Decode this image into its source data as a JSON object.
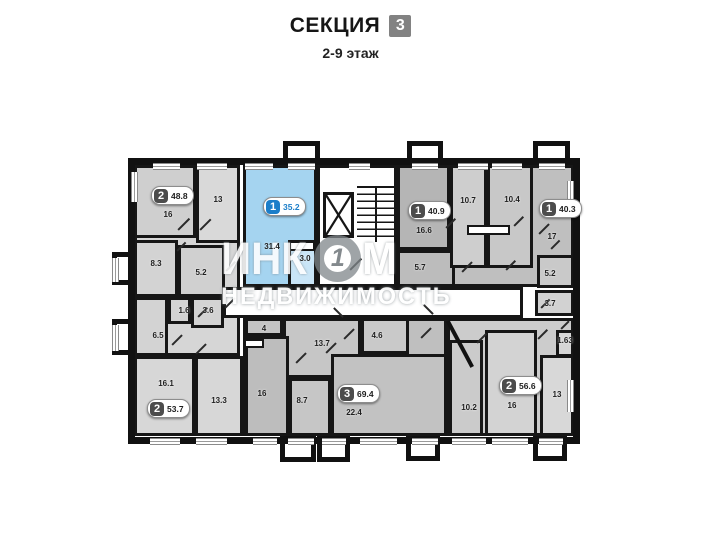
{
  "header": {
    "title": "СЕКЦИЯ",
    "section_number": "3",
    "subtitle": "2-9 этаж"
  },
  "watermark": {
    "part1": "ИНК",
    "logo_glyph": "1",
    "part2": "М",
    "line2": "НЕДВИЖИМОСТЬ"
  },
  "colors": {
    "highlight_apartment": "#a5d4f0",
    "highlight_badge": "#1b7ec9",
    "badge_square": "#4c4c4c",
    "section_badge": "#828282",
    "wall": "#111111"
  },
  "plan": {
    "rooms": [
      {
        "n": "hall-left",
        "x": 134,
        "y": 235,
        "w": 106,
        "h": 121,
        "bg": "#d6d6d6"
      },
      {
        "n": "room-16-top",
        "x": 134,
        "y": 165,
        "w": 62,
        "h": 73,
        "bg": "#cfcfcf"
      },
      {
        "n": "room-13-top",
        "x": 196,
        "y": 165,
        "w": 44,
        "h": 78,
        "bg": "#d9d9d9"
      },
      {
        "n": "room-8-3",
        "x": 134,
        "y": 240,
        "w": 44,
        "h": 57,
        "bg": "#d3d3d3"
      },
      {
        "n": "room-5-2-left",
        "x": 178,
        "y": 245,
        "w": 47,
        "h": 52,
        "bg": "#d0d0d0"
      },
      {
        "n": "room-1-6",
        "x": 168,
        "y": 297,
        "w": 23,
        "h": 27,
        "bg": "#d3d3d3"
      },
      {
        "n": "room-3-6",
        "x": 191,
        "y": 297,
        "w": 33,
        "h": 31,
        "bg": "#d3d3d3"
      },
      {
        "n": "room-6-5",
        "x": 134,
        "y": 297,
        "w": 34,
        "h": 59,
        "bg": "#d3d3d3"
      },
      {
        "n": "room-16-1",
        "x": 134,
        "y": 356,
        "w": 61,
        "h": 80,
        "bg": "#d7d7d7"
      },
      {
        "n": "room-13-3",
        "x": 195,
        "y": 356,
        "w": 48,
        "h": 80,
        "bg": "#d7d7d7"
      },
      {
        "n": "apt-highlight-35-2",
        "x": 243,
        "y": 165,
        "w": 74,
        "h": 122,
        "bg": "#a5d4f0"
      },
      {
        "n": "room-3-0",
        "x": 288,
        "y": 240,
        "w": 29,
        "h": 47,
        "bg": "#c9e5f7"
      },
      {
        "n": "stair-core",
        "x": 317,
        "y": 165,
        "w": 80,
        "h": 122,
        "bg": "#ffffff"
      },
      {
        "n": "apt-topright-base",
        "x": 397,
        "y": 165,
        "w": 177,
        "h": 122,
        "bg": "#bfbfbf"
      },
      {
        "n": "room-16-6",
        "x": 397,
        "y": 165,
        "w": 53,
        "h": 85,
        "bg": "#b5b5b5"
      },
      {
        "n": "room-5-7",
        "x": 397,
        "y": 250,
        "w": 58,
        "h": 37,
        "bg": "#bcbcbc"
      },
      {
        "n": "room-10-7",
        "x": 450,
        "y": 165,
        "w": 37,
        "h": 103,
        "bg": "#cecece"
      },
      {
        "n": "room-10-4",
        "x": 487,
        "y": 165,
        "w": 46,
        "h": 103,
        "bg": "#c8c8c8"
      },
      {
        "n": "room-5-2-right",
        "x": 537,
        "y": 255,
        "w": 37,
        "h": 33,
        "bg": "#c9c9c9"
      },
      {
        "n": "room-3-7",
        "x": 535,
        "y": 290,
        "w": 39,
        "h": 26,
        "bg": "#d2d2d2"
      },
      {
        "n": "apt-botmid-base",
        "x": 243,
        "y": 318,
        "w": 204,
        "h": 118,
        "bg": "#bfbfbf"
      },
      {
        "n": "room-4",
        "x": 245,
        "y": 318,
        "w": 38,
        "h": 18,
        "bg": "#c4c4c4"
      },
      {
        "n": "room-13-7",
        "x": 283,
        "y": 318,
        "w": 78,
        "h": 60,
        "bg": "#c6c6c6"
      },
      {
        "n": "room-4-6",
        "x": 361,
        "y": 318,
        "w": 48,
        "h": 36,
        "bg": "#c9c9c9"
      },
      {
        "n": "room-16-mid",
        "x": 245,
        "y": 336,
        "w": 44,
        "h": 100,
        "bg": "#bdbdbd"
      },
      {
        "n": "room-8-7",
        "x": 289,
        "y": 378,
        "w": 42,
        "h": 58,
        "bg": "#c6c6c6"
      },
      {
        "n": "room-22-4",
        "x": 331,
        "y": 354,
        "w": 116,
        "h": 82,
        "bg": "#c2c2c2"
      },
      {
        "n": "apt-botright-base",
        "x": 447,
        "y": 318,
        "w": 127,
        "h": 118,
        "bg": "#cccccc"
      },
      {
        "n": "room-10-2",
        "x": 449,
        "y": 340,
        "w": 34,
        "h": 96,
        "bg": "#cbcbcb"
      },
      {
        "n": "room-16-botright",
        "x": 485,
        "y": 330,
        "w": 52,
        "h": 106,
        "bg": "#d3d3d3"
      },
      {
        "n": "room-13-botright",
        "x": 540,
        "y": 355,
        "w": 34,
        "h": 81,
        "bg": "#d8d8d8"
      },
      {
        "n": "room-1-63",
        "x": 556,
        "y": 330,
        "w": 18,
        "h": 27,
        "bg": "#d6d6d6"
      },
      {
        "n": "corridor",
        "x": 223,
        "y": 287,
        "w": 300,
        "h": 31,
        "bg": "#ffffff"
      }
    ],
    "white_details": [
      {
        "x": 289,
        "y": 241,
        "w": 26,
        "h": 10
      },
      {
        "x": 467,
        "y": 225,
        "w": 43,
        "h": 10
      },
      {
        "x": 244,
        "y": 339,
        "w": 20,
        "h": 9
      }
    ],
    "stubs": [
      {
        "x": 283,
        "y": 141,
        "w": 37,
        "h": 26
      },
      {
        "x": 407,
        "y": 141,
        "w": 36,
        "h": 26
      },
      {
        "x": 533,
        "y": 141,
        "w": 37,
        "h": 26
      },
      {
        "x": 280,
        "y": 435,
        "w": 36,
        "h": 27
      },
      {
        "x": 317,
        "y": 435,
        "w": 33,
        "h": 27
      },
      {
        "x": 406,
        "y": 435,
        "w": 34,
        "h": 26
      },
      {
        "x": 533,
        "y": 435,
        "w": 34,
        "h": 26
      },
      {
        "x": 112,
        "y": 252,
        "w": 26,
        "h": 33
      },
      {
        "x": 112,
        "y": 319,
        "w": 26,
        "h": 36
      }
    ],
    "windows_h": [
      {
        "x": 153,
        "y": 163,
        "l": 27
      },
      {
        "x": 197,
        "y": 163,
        "l": 30
      },
      {
        "x": 245,
        "y": 163,
        "l": 28
      },
      {
        "x": 288,
        "y": 163,
        "l": 27
      },
      {
        "x": 349,
        "y": 163,
        "l": 21
      },
      {
        "x": 412,
        "y": 163,
        "l": 26
      },
      {
        "x": 458,
        "y": 163,
        "l": 30
      },
      {
        "x": 492,
        "y": 163,
        "l": 30
      },
      {
        "x": 539,
        "y": 163,
        "l": 26
      },
      {
        "x": 150,
        "y": 438,
        "l": 30
      },
      {
        "x": 196,
        "y": 438,
        "l": 31
      },
      {
        "x": 253,
        "y": 438,
        "l": 24
      },
      {
        "x": 288,
        "y": 438,
        "l": 26
      },
      {
        "x": 322,
        "y": 438,
        "l": 24
      },
      {
        "x": 360,
        "y": 438,
        "l": 37
      },
      {
        "x": 412,
        "y": 438,
        "l": 26
      },
      {
        "x": 452,
        "y": 438,
        "l": 34
      },
      {
        "x": 492,
        "y": 438,
        "l": 36
      },
      {
        "x": 539,
        "y": 438,
        "l": 24
      }
    ],
    "windows_v": [
      {
        "x": 131,
        "y": 172,
        "l": 30
      },
      {
        "x": 112,
        "y": 258,
        "l": 24
      },
      {
        "x": 112,
        "y": 325,
        "l": 26
      },
      {
        "x": 567,
        "y": 181,
        "l": 34
      },
      {
        "x": 567,
        "y": 380,
        "l": 32
      }
    ],
    "doors": [
      {
        "x": 178,
        "y": 229,
        "l": 16,
        "r": -45
      },
      {
        "x": 200,
        "y": 229,
        "l": 15,
        "r": -45
      },
      {
        "x": 177,
        "y": 250,
        "l": 12,
        "r": -45
      },
      {
        "x": 226,
        "y": 270,
        "l": 13,
        "r": -45
      },
      {
        "x": 198,
        "y": 316,
        "l": 13,
        "r": -45
      },
      {
        "x": 172,
        "y": 344,
        "l": 14,
        "r": -45
      },
      {
        "x": 196,
        "y": 353,
        "l": 14,
        "r": -45
      },
      {
        "x": 225,
        "y": 307,
        "l": 14,
        "r": -45
      },
      {
        "x": 350,
        "y": 269,
        "l": 16,
        "r": -45
      },
      {
        "x": 334,
        "y": 307,
        "l": 13,
        "r": 45
      },
      {
        "x": 296,
        "y": 362,
        "l": 14,
        "r": -45
      },
      {
        "x": 326,
        "y": 352,
        "l": 14,
        "r": -45
      },
      {
        "x": 344,
        "y": 338,
        "l": 14,
        "r": -45
      },
      {
        "x": 424,
        "y": 304,
        "l": 13,
        "r": 45
      },
      {
        "x": 462,
        "y": 271,
        "l": 14,
        "r": -45
      },
      {
        "x": 506,
        "y": 269,
        "l": 13,
        "r": -45
      },
      {
        "x": 446,
        "y": 227,
        "l": 13,
        "r": -45
      },
      {
        "x": 514,
        "y": 225,
        "l": 13,
        "r": -45
      },
      {
        "x": 539,
        "y": 233,
        "l": 14,
        "r": -45
      },
      {
        "x": 551,
        "y": 248,
        "l": 12,
        "r": -45
      },
      {
        "x": 541,
        "y": 307,
        "l": 12,
        "r": -45
      },
      {
        "x": 421,
        "y": 337,
        "l": 14,
        "r": -45
      },
      {
        "x": 477,
        "y": 342,
        "l": 13,
        "r": -45
      },
      {
        "x": 538,
        "y": 338,
        "l": 13,
        "r": -45
      },
      {
        "x": 561,
        "y": 328,
        "l": 11,
        "r": -45
      }
    ],
    "diag_walls": [
      {
        "x": 458,
        "y": 318,
        "h": 52,
        "r": -28
      }
    ],
    "badges": [
      {
        "rooms": "2",
        "area": "48.8",
        "x": 151,
        "y": 186,
        "variant": "gray"
      },
      {
        "rooms": "1",
        "area": "35.2",
        "x": 263,
        "y": 197,
        "variant": "blue"
      },
      {
        "rooms": "1",
        "area": "40.9",
        "x": 408,
        "y": 201,
        "variant": "gray"
      },
      {
        "rooms": "1",
        "area": "40.3",
        "x": 539,
        "y": 199,
        "variant": "gray"
      },
      {
        "rooms": "2",
        "area": "53.7",
        "x": 147,
        "y": 399,
        "variant": "gray"
      },
      {
        "rooms": "3",
        "area": "69.4",
        "x": 337,
        "y": 384,
        "variant": "gray"
      },
      {
        "rooms": "2",
        "area": "56.6",
        "x": 499,
        "y": 376,
        "variant": "gray"
      }
    ],
    "labels": [
      {
        "t": "16",
        "x": 168,
        "y": 215
      },
      {
        "t": "13",
        "x": 218,
        "y": 200
      },
      {
        "t": "31.4",
        "x": 272,
        "y": 247
      },
      {
        "t": "3.0",
        "x": 305,
        "y": 259
      },
      {
        "t": "16.6",
        "x": 424,
        "y": 231
      },
      {
        "t": "10.7",
        "x": 468,
        "y": 201
      },
      {
        "t": "10.4",
        "x": 512,
        "y": 200
      },
      {
        "t": "17",
        "x": 552,
        "y": 237
      },
      {
        "t": "8.3",
        "x": 156,
        "y": 264
      },
      {
        "t": "5.2",
        "x": 201,
        "y": 273
      },
      {
        "t": "1.6",
        "x": 184,
        "y": 311
      },
      {
        "t": "3.6",
        "x": 208,
        "y": 311
      },
      {
        "t": "6.5",
        "x": 158,
        "y": 336
      },
      {
        "t": "5.7",
        "x": 420,
        "y": 268
      },
      {
        "t": "5.2",
        "x": 550,
        "y": 274
      },
      {
        "t": "3.7",
        "x": 550,
        "y": 304
      },
      {
        "t": "1.63",
        "x": 565,
        "y": 341
      },
      {
        "t": "16.1",
        "x": 166,
        "y": 384
      },
      {
        "t": "13.3",
        "x": 219,
        "y": 401
      },
      {
        "t": "4",
        "x": 264,
        "y": 329
      },
      {
        "t": "13.7",
        "x": 322,
        "y": 344
      },
      {
        "t": "4.6",
        "x": 377,
        "y": 336
      },
      {
        "t": "16",
        "x": 262,
        "y": 394
      },
      {
        "t": "8.7",
        "x": 302,
        "y": 401
      },
      {
        "t": "22.4",
        "x": 354,
        "y": 413
      },
      {
        "t": "10.2",
        "x": 469,
        "y": 408
      },
      {
        "t": "16",
        "x": 512,
        "y": 406
      },
      {
        "t": "13",
        "x": 557,
        "y": 395
      }
    ]
  }
}
